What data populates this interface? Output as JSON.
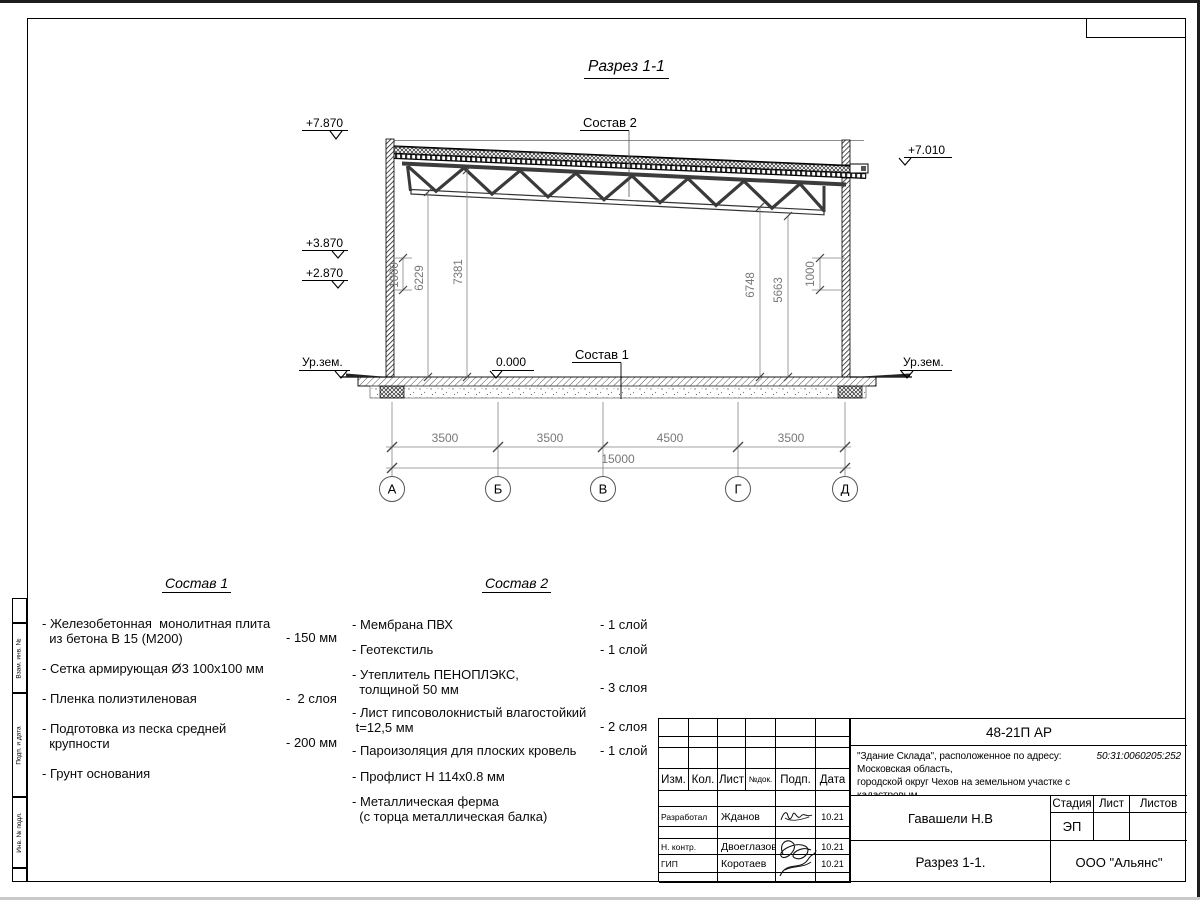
{
  "page": {
    "drawing_title": "Разрез 1-1"
  },
  "drawing": {
    "marks": {
      "top_left": "+7.870",
      "mid_left": "+3.870",
      "low_left": "+2.870",
      "ground_left": "Ур.зем.",
      "top_right": "+7.010",
      "ground_right": "Ур.зем.",
      "zero": "0.000"
    },
    "leaders": {
      "roof": "Состав 2",
      "floor": "Состав 1"
    },
    "vdims": {
      "left_1000": "1000",
      "left_6229": "6229",
      "left_7381": "7381",
      "right_6748": "6748",
      "right_5663": "5663",
      "right_1000": "1000"
    },
    "hdims": {
      "s1": "3500",
      "s2": "3500",
      "s3": "4500",
      "s4": "3500",
      "total": "15000"
    },
    "axes": {
      "a1": "А",
      "a2": "Б",
      "a3": "В",
      "a4": "Г",
      "a5": "Д"
    }
  },
  "composition1": {
    "title": "Состав 1",
    "items": [
      {
        "label": "- Железобетонная  монолитная плита\n  из бетона В 15 (М200)",
        "value": "- 150 мм"
      },
      {
        "label": "- Сетка армирующая Ø3 100х100 мм",
        "value": ""
      },
      {
        "label": "- Пленка полиэтиленовая",
        "value": "-  2 слоя"
      },
      {
        "label": "- Подготовка из песка средней\n  крупности",
        "value": "- 200 мм"
      },
      {
        "label": "- Грунт основания",
        "value": ""
      }
    ]
  },
  "composition2": {
    "title": "Состав 2",
    "items": [
      {
        "label": "- Мембрана ПВХ",
        "value": "- 1 слой"
      },
      {
        "label": "- Геотекстиль",
        "value": "- 1 слой"
      },
      {
        "label": "- Утеплитель ПЕНОПЛЭКС,\n  толщиной 50 мм",
        "value": "- 3 слоя"
      },
      {
        "label": "- Лист гипсоволокнистый влагостойкий\n t=12,5 мм",
        "value": "- 2 слоя"
      },
      {
        "label": "- Пароизоляция для плоских кровель",
        "value": "- 1 слой"
      },
      {
        "label": "- Профлист Н 114х0.8 мм",
        "value": ""
      },
      {
        "label": "- Металлическая ферма\n  (с торца металлическая балка)",
        "value": ""
      }
    ]
  },
  "title_block": {
    "code": "48-21П АР",
    "description": "\"Здание Склада\", расположенное по адресу: Московская область,\nгородской округ Чехов на земельном участке с кадастровым\nномером ",
    "cadastral_number": "50:31:0060205:252",
    "columns": {
      "izm": "Изм.",
      "kol": "Кол.",
      "list": "Лист",
      "ndok": "№док.",
      "podp": "Подп.",
      "data": "Дата"
    },
    "rows": [
      {
        "role": "Разработал",
        "name": "Жданов",
        "date": "10.21"
      },
      {
        "role": "Н. контр.",
        "name": "Двоеглазов",
        "date": "10.21"
      },
      {
        "role": "ГИП",
        "name": "Коротаев",
        "date": "10.21"
      }
    ],
    "name_cell": "Гавашели Н.В",
    "stage": {
      "stadia": "Стадия",
      "list": "Лист",
      "listov": "Листов",
      "stage_value": "ЭП"
    },
    "sheet_title": "Разрез 1-1.",
    "company": "ООО \"Альянс\""
  },
  "side_strip": {
    "box1": "Взам. инв. №",
    "box2": "Подп. и дата",
    "box3": "Инв. № подл."
  }
}
